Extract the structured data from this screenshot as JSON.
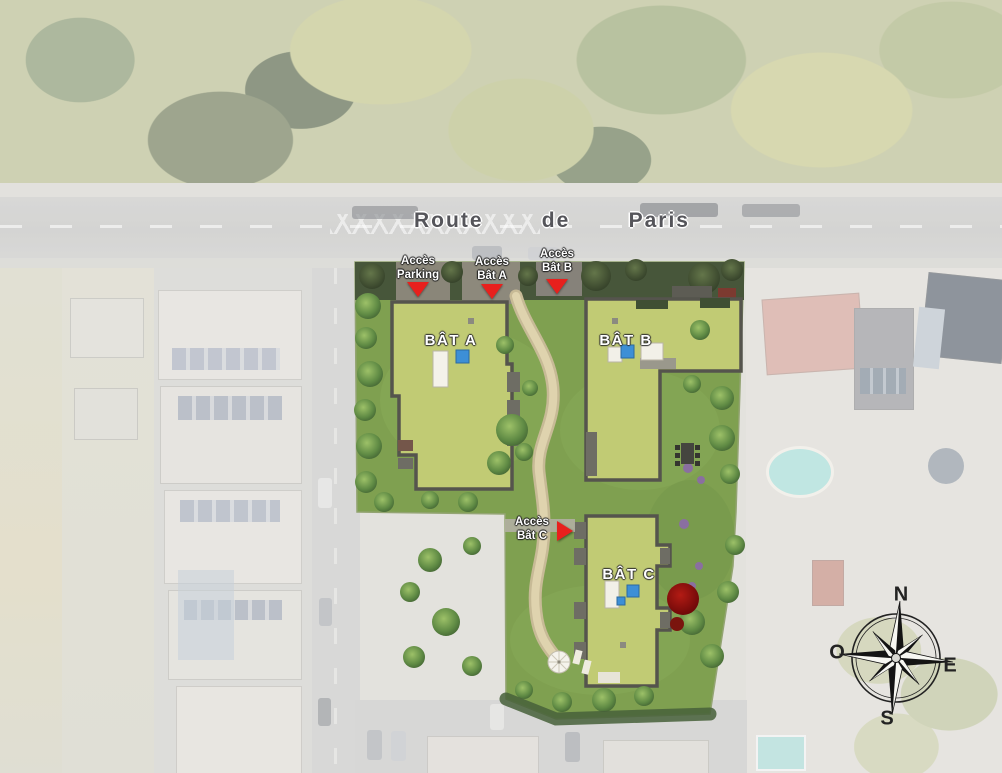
{
  "map": {
    "road": {
      "words": [
        "Route",
        "de",
        "Paris"
      ]
    },
    "access": [
      {
        "line1": "Accès",
        "line2": "Parking",
        "direction": "down"
      },
      {
        "line1": "Accès",
        "line2": "Bât A",
        "direction": "down"
      },
      {
        "line1": "Accès",
        "line2": "Bât B",
        "direction": "down"
      },
      {
        "line1": "Accès",
        "line2": "Bât C",
        "direction": "right"
      }
    ],
    "buildings": [
      {
        "label": "BÂT A"
      },
      {
        "label": "BÂT B"
      },
      {
        "label": "BÂT C"
      }
    ],
    "compass": {
      "n": "N",
      "e": "E",
      "s": "S",
      "o": "O"
    },
    "colors": {
      "marker_red": "#e8201d",
      "roof_lawn": "#c1cb74",
      "garden_green": "#7fa050",
      "path_beige": "#d9cda8",
      "parapet_gray": "#55544d",
      "accent_blue": "#3d8fd6",
      "red_tree": "#8c1010"
    }
  }
}
